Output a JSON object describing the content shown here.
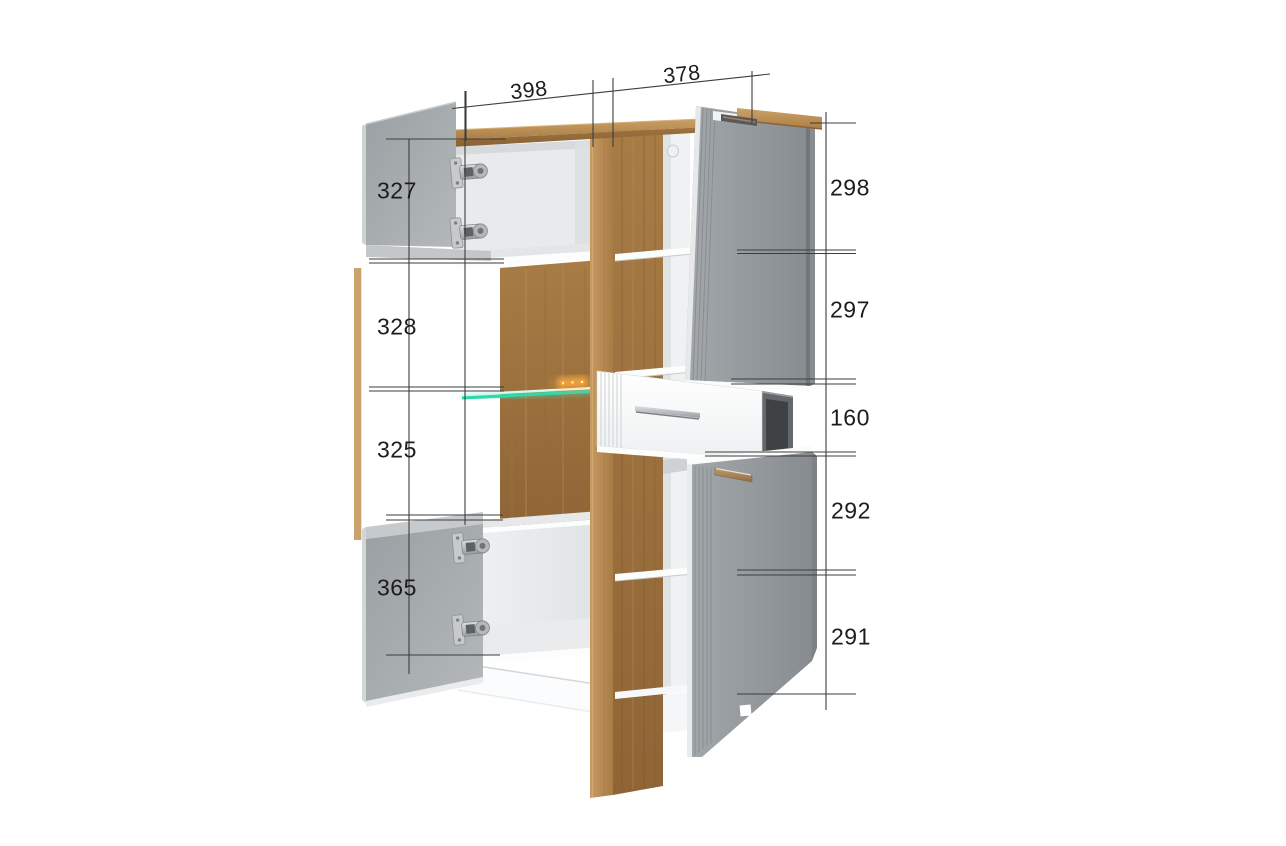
{
  "diagram": {
    "kind": "furniture-dimension-diagram",
    "subject": "display cabinet with open doors, pulled-out drawer and LED glass shelf",
    "background": "#ffffff"
  },
  "measurements": {
    "top": {
      "left_section_width": "398",
      "right_section_width": "378"
    },
    "left": {
      "upper_door_height": "327",
      "display_upper_height": "328",
      "display_lower_height": "325",
      "lower_door_height": "365"
    },
    "right": {
      "top_section_height": "298",
      "upper_middle_section_height": "297",
      "drawer_section_height": "160",
      "lower_middle_section_height": "292",
      "bottom_section_height": "291"
    }
  },
  "colors": {
    "wood_light": "#c1945c",
    "wood_top": "#b98e55",
    "wood_dark_panel": "#9c7340",
    "door_gray": "#9aa0a3",
    "door_gray_inner": "#aeb3b6",
    "carcass_white": "#f1f2f3",
    "glass_shelf_teal": "#2fd8a9",
    "led_orange": "#ff9d2b",
    "handle_copper": "#b08a62",
    "dimension_line": "#3d3d3d",
    "label_text": "#1c1c1c"
  }
}
